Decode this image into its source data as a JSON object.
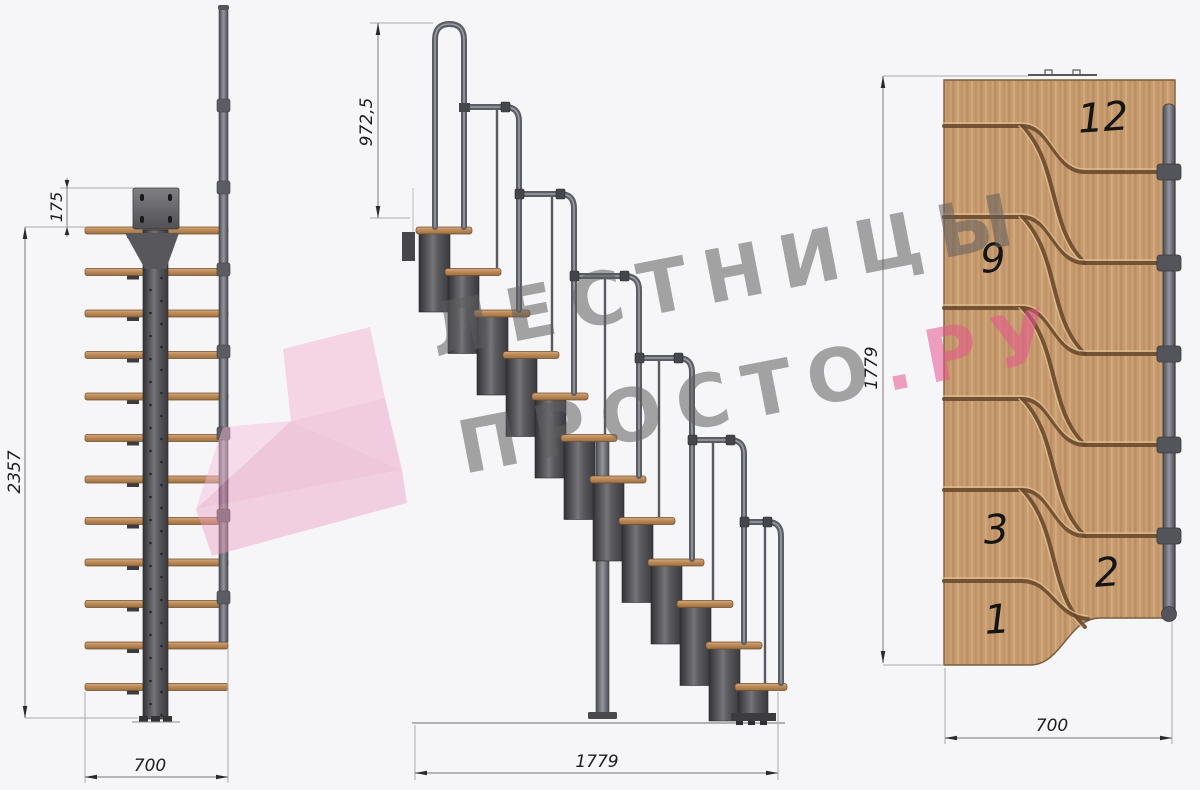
{
  "watermark": {
    "line1": "ЛЕСТНИЦЫ",
    "line2_gray": "ПРОСТО",
    "line2_pink": ".РУ",
    "accent_pink": "#e7558f",
    "gray": "#a8a8a8"
  },
  "front_view": {
    "dim_top_offset": "175",
    "dim_height": "2357",
    "dim_width": "700"
  },
  "side_view": {
    "dim_handrail_height": "972,5",
    "dim_length": "1779"
  },
  "plan_view": {
    "dim_length": "1779",
    "dim_width": "700",
    "step_numbers": {
      "s12": "12",
      "s9": "9",
      "s3": "3",
      "s2": "2",
      "s1": "1"
    }
  },
  "colors": {
    "background": "#f6f6f8",
    "wood": "#c69b6f",
    "wood_groove": "#6a4a2d",
    "metal_dark": "#3a3a3e",
    "pipe_gray": "#5c5d64"
  }
}
